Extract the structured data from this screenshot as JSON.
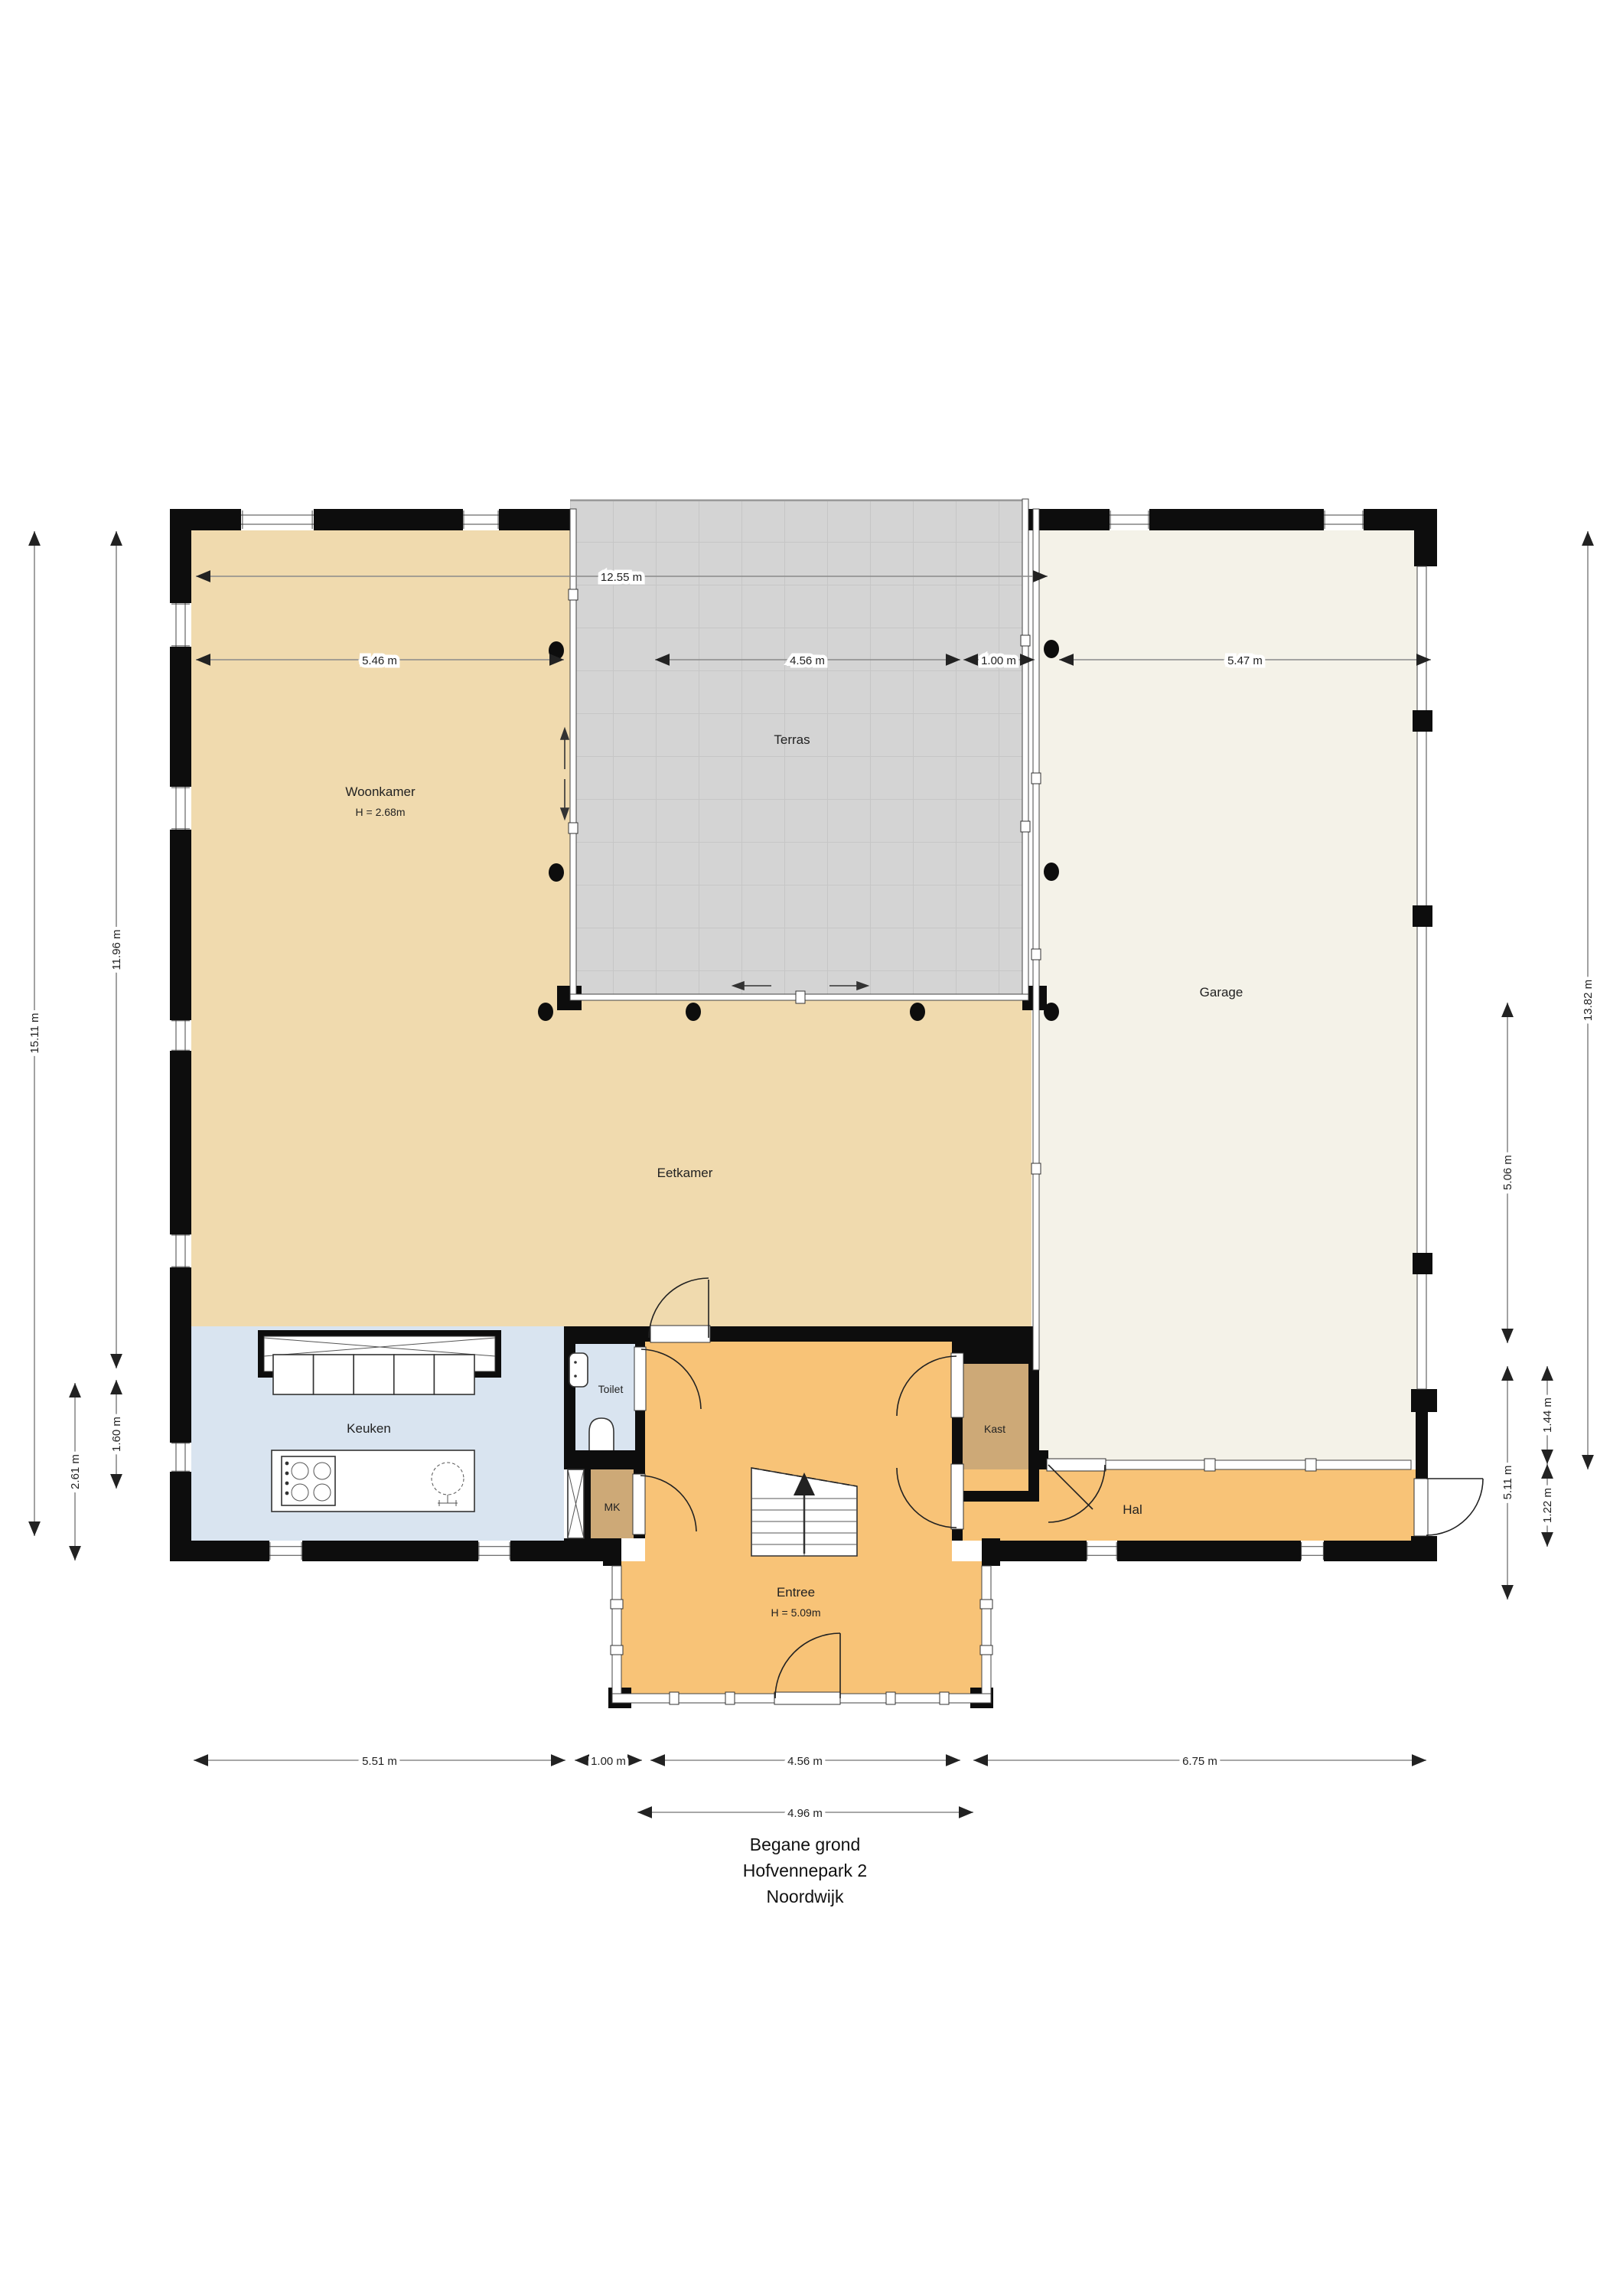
{
  "title": {
    "line1": "Begane grond",
    "line2": "Hofvennepark 2",
    "line3": "Noordwijk"
  },
  "rooms": {
    "woonkamer": {
      "label": "Woonkamer",
      "height": "H = 2.68m"
    },
    "terras": {
      "label": "Terras"
    },
    "garage": {
      "label": "Garage"
    },
    "eetkamer": {
      "label": "Eetkamer"
    },
    "keuken": {
      "label": "Keuken"
    },
    "toilet": {
      "label": "Toilet"
    },
    "mk": {
      "label": "MK"
    },
    "kast": {
      "label": "Kast"
    },
    "hal": {
      "label": "Hal"
    },
    "entree": {
      "label": "Entree",
      "height": "H = 5.09m"
    }
  },
  "dimensions": {
    "top": {
      "total": "12.55 m",
      "segments": [
        "5.46 m",
        "4.56 m",
        "1.00 m",
        "5.47 m"
      ]
    },
    "bottom": {
      "segments": [
        "5.51 m",
        "1.00 m",
        "4.56 m",
        "6.75 m"
      ],
      "entree_width": "4.96 m"
    },
    "left": {
      "total": "15.11 m",
      "upper": "11.96 m",
      "counter": "1.60 m",
      "keuken_depth": "2.61 m"
    },
    "right": {
      "total": "13.82 m",
      "garage_lower": "5.06 m",
      "hal_lower": "5.11 m",
      "seg_a": "1.44 m",
      "seg_b": "1.22 m"
    }
  },
  "colors": {
    "living_beige": "#F0DAAE",
    "terras_gray": "#D4D4D4",
    "terras_grid": "#C6C6C6",
    "garage_cream": "#F4F2E8",
    "kitchen_blue": "#D9E4F0",
    "hall_orange": "#F8C377",
    "closet_brown": "#CDA977",
    "wall_black": "#0D0D0D"
  }
}
